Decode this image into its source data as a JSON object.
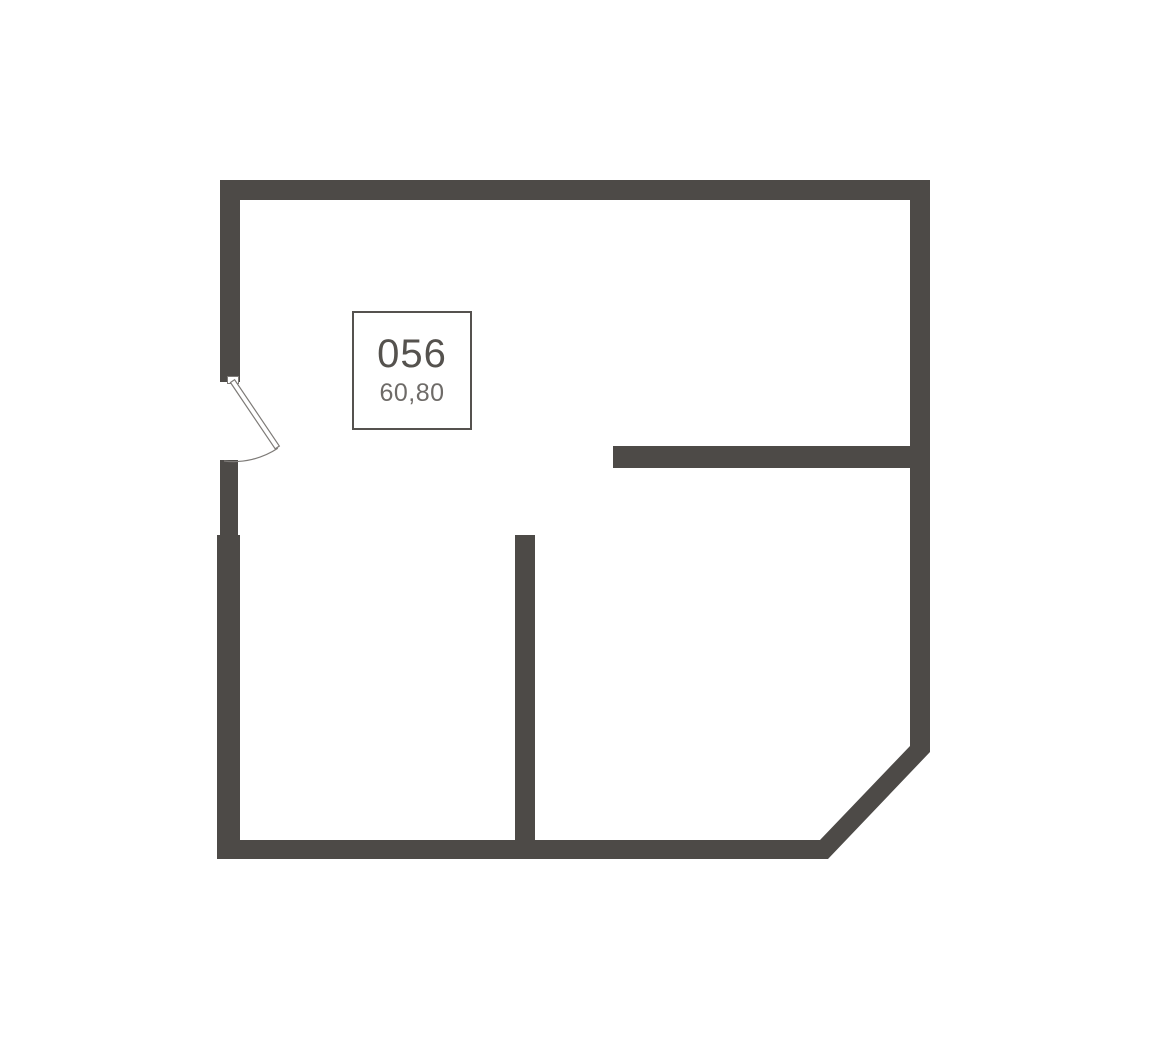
{
  "unit": {
    "number": "056",
    "area": "60,80"
  },
  "colors": {
    "wall": "#4d4a47",
    "label_border": "#55524f",
    "number_text": "#55524e",
    "area_text": "#6e6b68",
    "door_line": "#7d7a77",
    "background": "#ffffff"
  }
}
